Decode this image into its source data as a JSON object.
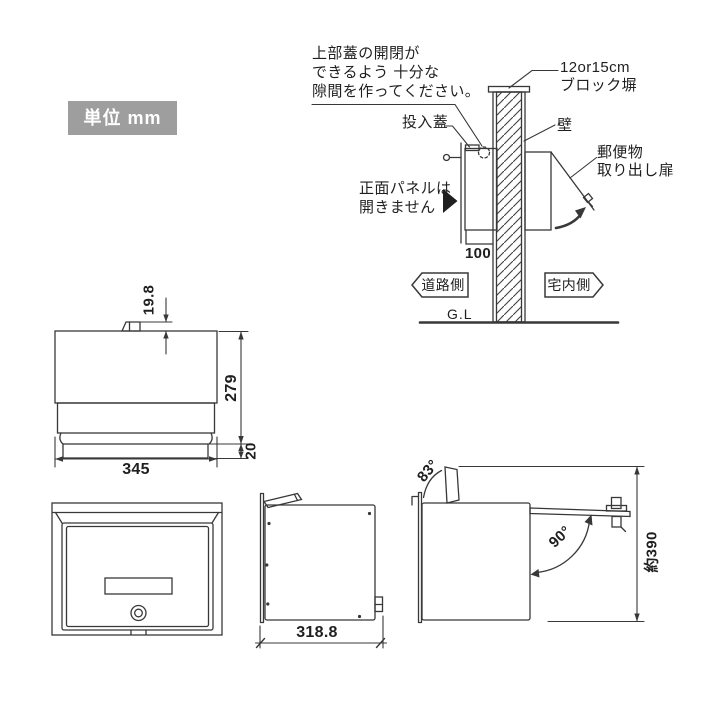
{
  "colors": {
    "line": "#383838",
    "badge_bg": "#9e9e9e",
    "badge_text": "#ffffff"
  },
  "unit_badge": {
    "label": "単位 mm"
  },
  "installation_diagram": {
    "gap_note": {
      "line1": "上部蓋の開閉が",
      "line2": "できるよう 十分な",
      "line3": "隙間を作ってください。"
    },
    "slot_lid_label": "投入蓋",
    "block_wall_label": {
      "line1": "12or15cm",
      "line2": "ブロック塀"
    },
    "wall_label": "壁",
    "retrieval_door_label": {
      "line1": "郵便物",
      "line2": "取り出し扉"
    },
    "front_panel_note": {
      "line1": "正面パネルは",
      "line2": "開きません"
    },
    "embed_depth_dim": "100",
    "road_side_label": "道路側",
    "house_side_label": "宅内側",
    "ground_level_label": "G.L"
  },
  "plan_view": {
    "tab_height_dim": "19.8",
    "body_height_dim": "279",
    "base_height_dim": "20",
    "width_dim": "345"
  },
  "side_view": {
    "depth_dim": "318.8"
  },
  "open_view": {
    "lid_angle_dim": "83°",
    "door_angle_dim": "90°",
    "total_height_dim": "約390"
  }
}
